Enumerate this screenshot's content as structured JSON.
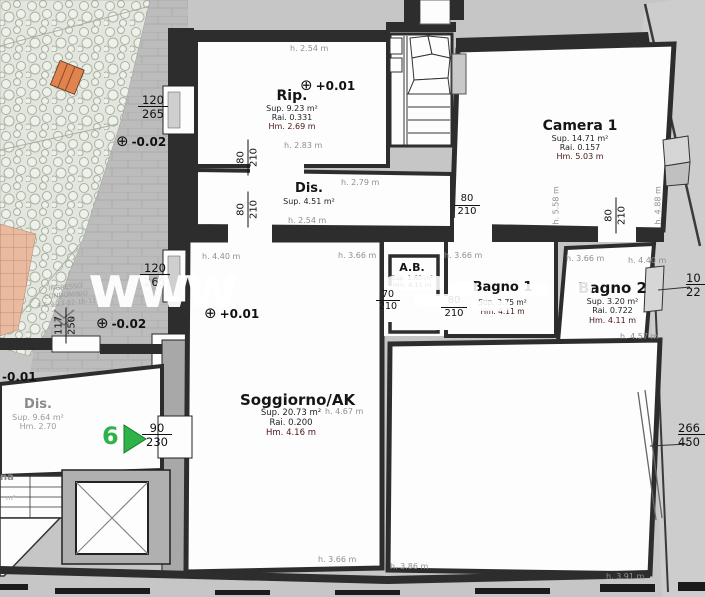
{
  "watermark": {
    "text": "www"
  },
  "rooms": {
    "rip": {
      "name": "Rip.",
      "sup": "Sup. 9.23 m²",
      "rai": "Rai. 0.331",
      "hm": "Hm. 2.69 m"
    },
    "camera1": {
      "name": "Camera 1",
      "sup": "Sup. 14.71 m²",
      "rai": "Rai. 0.157",
      "hm": "Hm. 5.03 m"
    },
    "dis_top": {
      "name": "Dis.",
      "sup": "Sup. 4.51 m²"
    },
    "ab": {
      "name": "A.B.",
      "sup": "Sup. 1.60 m²",
      "hm": "Hm. 4.11 m"
    },
    "bagno1": {
      "name": "Bagno 1",
      "sup": "Sup. 3.75 m²",
      "hm": "Hm. 4.11 m"
    },
    "bagno2": {
      "name": "Bagno 2",
      "sup": "Sup. 3.20 m²",
      "rai": "Rai. 0.722",
      "hm": "Hm. 4.11 m"
    },
    "soggiorno": {
      "name": "Soggiorno/AK",
      "sup": "Sup. 20.73 m²",
      "rai": "Rai. 0.200",
      "hm": "Hm. 4.16 m"
    },
    "dis_left": {
      "name": "Dis.",
      "sup": "Sup. 9.64 m²",
      "hm": "Hm. 2.70"
    },
    "partial_left": {
      "name": "na",
      "fragment": "m²"
    }
  },
  "heights": {
    "rip_top": "h. 2.54 m",
    "rip_bottom": "h. 2.83 m",
    "dis_mid": "h. 2.79 m",
    "dis_bottom": "h. 2.54 m",
    "sogg_tl": "h. 4.40 m",
    "sogg_tr": "h. 3.66 m",
    "bagno1_top": "h. 3.66 m",
    "bagno2_tl": "h. 3.66 m",
    "bagno2_tr": "h. 4.40 m",
    "bagno2_bottom": "h. 4.57 m",
    "sogg_right": "h. 4.67 m",
    "sogg_bottom": "h. 3.66 m",
    "br_bottom_left": "h. 3.86 m",
    "br_bottom_right": "h. 3.91 m",
    "camera1_vert_left": "h. 5.58 m",
    "camera1_vert_right": "h. 4.88 m"
  },
  "door_dims": {
    "d80_210": {
      "top": "80",
      "bottom": "210"
    },
    "d70_210": {
      "top": "70",
      "bottom": "210"
    },
    "d90_230": {
      "top": "90",
      "bottom": "230"
    },
    "d117_250": {
      "top": "117",
      "bottom": "250"
    },
    "d120_265": {
      "top": "120",
      "bottom": "265"
    },
    "d266_450": {
      "top": "266",
      "bottom": "450"
    },
    "d10_22": {
      "top": "10",
      "bottom": "22"
    }
  },
  "elevations": {
    "plus001": "+0.01",
    "minus002": "-0.02",
    "minus001": "-0.01",
    "symbol": "⊕"
  },
  "entrance": {
    "line1": "INGRESSO",
    "line2": "CONDOMINIO",
    "line3": "4-6-9-13-82-16-11"
  },
  "unit_marker": {
    "number": "6"
  },
  "colors": {
    "accent_green": "#2eb34a",
    "accent_orange": "#e0834e",
    "wall": "#2d2d2d",
    "paper_gray": "#c6c6c6"
  }
}
